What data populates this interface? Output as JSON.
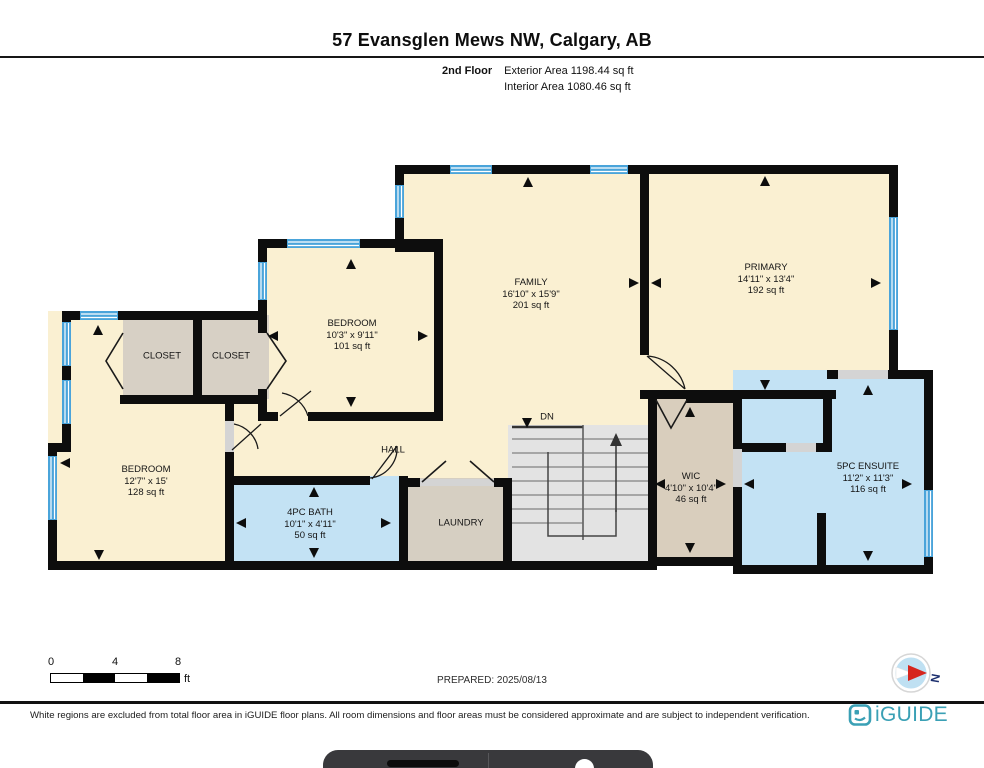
{
  "header": {
    "title": "57 Evansglen Mews NW, Calgary, AB",
    "floor_label": "2nd Floor",
    "exterior_area": "Exterior Area 1198.44 sq ft",
    "interior_area": "Interior Area 1080.46 sq ft"
  },
  "rooms": {
    "family": {
      "name": "FAMILY",
      "dims": "16'10\" x 15'9\"",
      "area": "201 sq ft"
    },
    "primary": {
      "name": "PRIMARY",
      "dims": "14'11\" x 13'4\"",
      "area": "192 sq ft"
    },
    "bedroom2": {
      "name": "BEDROOM",
      "dims": "10'3\" x 9'11\"",
      "area": "101 sq ft"
    },
    "closet1": {
      "name": "CLOSET"
    },
    "closet2": {
      "name": "CLOSET"
    },
    "bedroom3": {
      "name": "BEDROOM",
      "dims": "12'7\" x 15'",
      "area": "128 sq ft"
    },
    "hall": {
      "name": "HALL"
    },
    "bath": {
      "name": "4PC BATH",
      "dims": "10'1\" x 4'11\"",
      "area": "50 sq ft"
    },
    "laundry": {
      "name": "LAUNDRY"
    },
    "wic": {
      "name": "WIC",
      "dims": "4'10\" x 10'4\"",
      "area": "46 sq ft"
    },
    "ensuite": {
      "name": "5PC ENSUITE",
      "dims": "11'2\" x 11'3\"",
      "area": "116 sq ft"
    },
    "stairs": {
      "label": "DN"
    }
  },
  "scale_bar": {
    "ticks": [
      "0",
      "4",
      "8"
    ],
    "unit": "ft"
  },
  "prepared_label": "PREPARED: 2025/08/13",
  "compass": {
    "north_label": "N"
  },
  "footer": {
    "disclaimer": "White regions are excluded from total floor area in iGUIDE floor plans. All room dimensions and floor areas must be considered approximate and are subject to independent verification.",
    "brand": "iGUIDE"
  },
  "colors": {
    "room_fill": "#faf0d2",
    "closet_fill": "#d7d0c5",
    "wic_fill": "#d9cebd",
    "wet_room_fill": "#c3e2f4",
    "stairs_fill": "#e3e3e3",
    "wall": "#0d0d0d",
    "window_blue": "#4aa4da",
    "brand_teal": "#3aa0b5"
  }
}
